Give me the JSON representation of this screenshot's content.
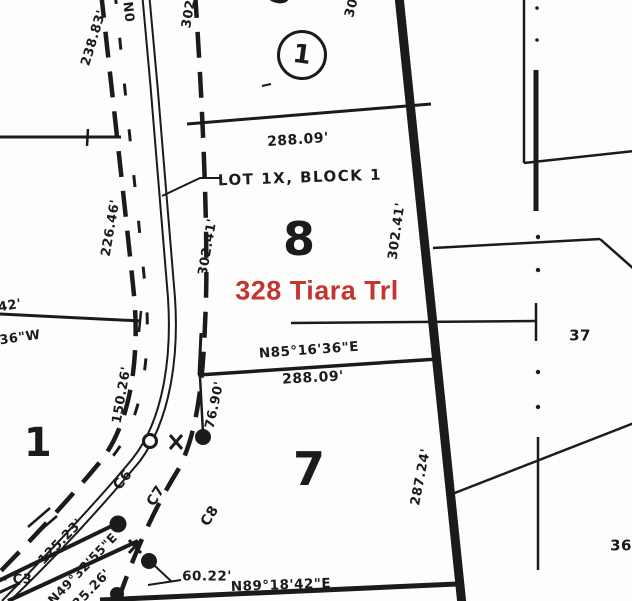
{
  "title": "Plat map - 328 Tiara Trl",
  "colors": {
    "ink": "#1b1b1b",
    "address_red": "#c43530",
    "background": "#fdfdfc"
  },
  "address_overlay": {
    "text": "328 Tiara Trl"
  },
  "lot_numbers": {
    "lot8": "8",
    "lot7": "7",
    "lot1": "1",
    "lot37": "37",
    "lot36": "36",
    "lot5_partial": "5",
    "block_circle": "1"
  },
  "lot_labels": {
    "lot1x_block1": "LOT 1X, BLOCK 1"
  },
  "dimensions": {
    "d238": "238.83'",
    "d226": "226.46'",
    "d150": "150.26'",
    "d302L": "302.41'",
    "d302R": "302.41'",
    "d288top": "288.09'",
    "d288mid": "288.09'",
    "d76": "76.90'",
    "d287": "287.24'",
    "d125": "125.23'",
    "d25": "25.26'",
    "d60": "60.22'"
  },
  "bearings": {
    "n85": "N85°16'36\"E",
    "n49": "N49°32'55\"E",
    "n89": "N89°18'42\"E",
    "frag42": "42'",
    "frag36w": "36\"W",
    "fragN0": "N0",
    "frag302": "302",
    "frag30": "30"
  },
  "curves": {
    "c3": "- C3",
    "c6": "C6",
    "c7": "C7",
    "c8": "C8"
  }
}
